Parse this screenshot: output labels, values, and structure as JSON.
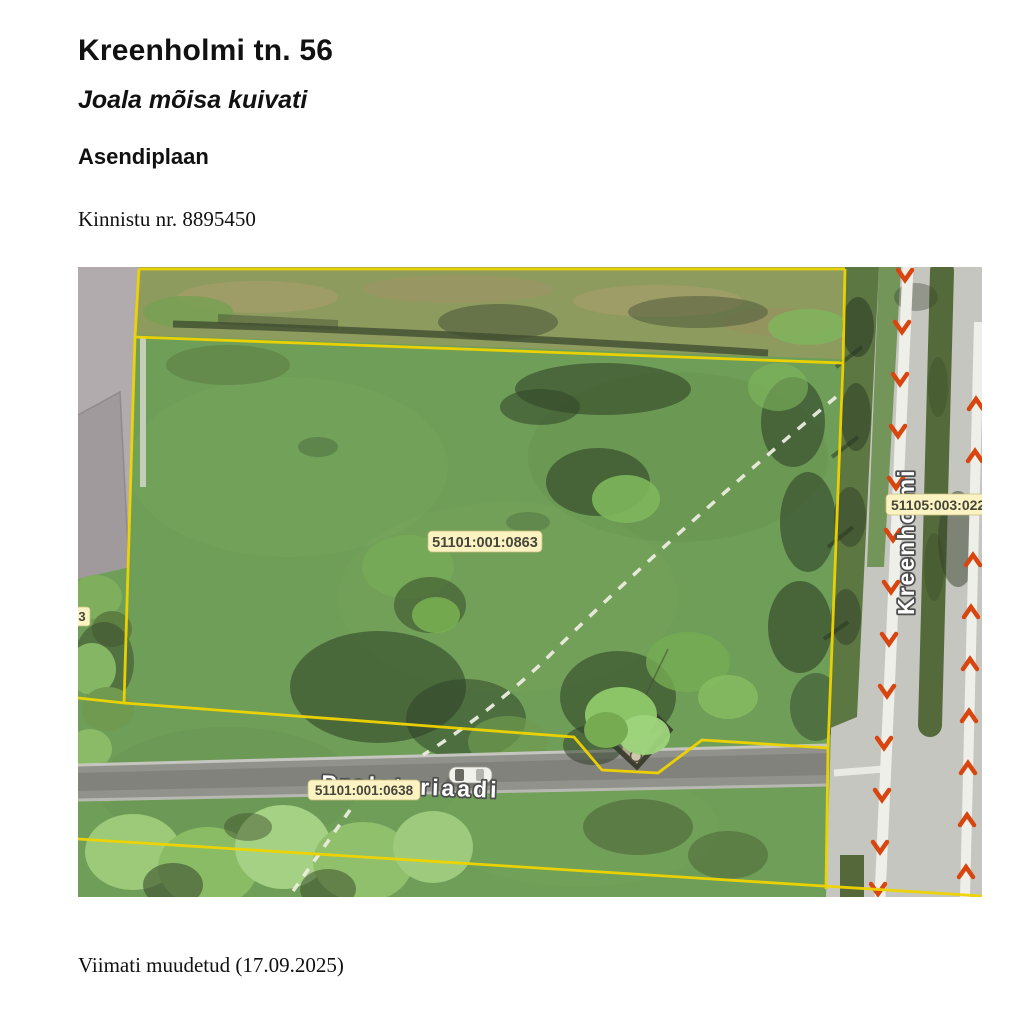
{
  "page": {
    "title": "Kreenholmi tn. 56",
    "subtitle": "Joala mõisa kuivati",
    "section": "Asendiplaan",
    "registry_line": "Kinnistu nr. 8895450",
    "footer": "Viimati muudetud (17.09.2025)"
  },
  "map": {
    "labels": {
      "parcel": "51101:001:0863",
      "road_parcel": "51101:001:0638",
      "east_parcel": "51105:003:022",
      "west_edge": "3"
    },
    "streets": {
      "horizontal": "Proletariaadi",
      "vertical": "Kreenholmi"
    },
    "colors": {
      "boundary_yellow": "#f0d400",
      "cadastral_label_bg": "#fbf3c2",
      "cadastral_label_text": "#47463a",
      "direction_arrow_red": "#d8450e",
      "street_name_fill": "#ffffff",
      "street_name_outline": "#4d4d4d"
    }
  }
}
